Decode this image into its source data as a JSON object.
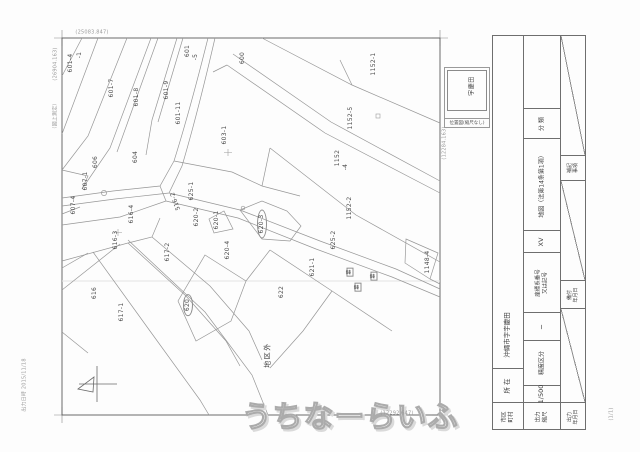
{
  "watermark": {
    "text": "うちなーらいふ"
  },
  "page_number": "(1/1)",
  "print_note": "出力日時 2015/11/18",
  "coords": {
    "top_left_h": "(25083.847)",
    "top_left_v": "(26904.163)",
    "left_note": "（図上測定）",
    "bottom_right_h": "(12292.647)",
    "right_v": "(12284.163)"
  },
  "inset": {
    "area_name": "宇慶田",
    "caption": "位置図(縮尺なし)"
  },
  "map": {
    "district_note": "地区外",
    "parcels": [
      {
        "t": "601-4",
        "x": 71,
        "y": 63
      },
      {
        "t": "-1",
        "x": 80,
        "y": 55
      },
      {
        "t": "601-7",
        "x": 112,
        "y": 88
      },
      {
        "t": "601-8",
        "x": 137,
        "y": 97
      },
      {
        "t": "601-9",
        "x": 167,
        "y": 90
      },
      {
        "t": "601-11",
        "x": 179,
        "y": 113
      },
      {
        "t": "601",
        "x": 188,
        "y": 51
      },
      {
        "t": "-5",
        "x": 196,
        "y": 57
      },
      {
        "t": "600",
        "x": 243,
        "y": 58
      },
      {
        "t": "1152-1",
        "x": 374,
        "y": 64
      },
      {
        "t": "1152-5",
        "x": 351,
        "y": 118
      },
      {
        "t": "1152",
        "x": 338,
        "y": 158
      },
      {
        "t": "-4",
        "x": 346,
        "y": 167
      },
      {
        "t": "1152-2",
        "x": 350,
        "y": 208
      },
      {
        "t": "603-1",
        "x": 225,
        "y": 135
      },
      {
        "t": "604",
        "x": 136,
        "y": 157
      },
      {
        "t": "606",
        "x": 96,
        "y": 162
      },
      {
        "t": "607-1",
        "x": 86,
        "y": 181
      },
      {
        "t": "607-4",
        "x": 74,
        "y": 205
      },
      {
        "t": "516-2",
        "x": 176,
        "y": 201,
        "rot": -110
      },
      {
        "t": "616-4",
        "x": 132,
        "y": 214
      },
      {
        "t": "616-3",
        "x": 116,
        "y": 240
      },
      {
        "t": "617-2",
        "x": 168,
        "y": 252
      },
      {
        "t": "625-1",
        "x": 192,
        "y": 191
      },
      {
        "t": "620-2",
        "x": 197,
        "y": 217
      },
      {
        "t": "620-1",
        "x": 217,
        "y": 220
      },
      {
        "t": "620-3",
        "x": 262,
        "y": 224,
        "ellipse": true
      },
      {
        "t": "620-4",
        "x": 228,
        "y": 250
      },
      {
        "t": "625-2",
        "x": 334,
        "y": 240
      },
      {
        "t": "621-1",
        "x": 313,
        "y": 267
      },
      {
        "t": "622",
        "x": 282,
        "y": 292
      },
      {
        "t": "616",
        "x": 95,
        "y": 293
      },
      {
        "t": "617-1",
        "x": 122,
        "y": 312
      },
      {
        "t": "620",
        "x": 188,
        "y": 305,
        "ellipse": true
      },
      {
        "t": "1148-4",
        "x": 428,
        "y": 262
      },
      {
        "t": "墓",
        "x": 350,
        "y": 272,
        "boxed": true
      },
      {
        "t": "墓",
        "x": 374,
        "y": 276,
        "boxed": true
      },
      {
        "t": "墓",
        "x": 358,
        "y": 287,
        "boxed": true
      },
      {
        "t": "地区外",
        "x": 268,
        "y": 355,
        "big": true
      }
    ]
  },
  "title_block": {
    "y": 35,
    "h": 395,
    "columns": [
      {
        "x": 492,
        "w": 32,
        "cells": [
          {
            "kind": "blank",
            "h": 265,
            "noline": true
          },
          {
            "kind": "text",
            "h": 68,
            "text": "沖縄市字宇慶田",
            "fs": 6.5
          },
          {
            "kind": "text",
            "h": 34,
            "text": "所 在",
            "fs": 6.5
          },
          {
            "kind": "text2",
            "h": 28,
            "lines": [
              "市区",
              "町村"
            ],
            "fs": 5.5
          }
        ]
      },
      {
        "x": 523,
        "w": 38,
        "cells": [
          {
            "kind": "blank",
            "h": 73
          },
          {
            "kind": "text",
            "h": 30,
            "text": "分 類",
            "fs": 6
          },
          {
            "kind": "text",
            "h": 92,
            "text": "地図（法第14条第1項）",
            "fs": 6
          },
          {
            "kind": "text",
            "h": 22,
            "text": "XV",
            "fs": 6.5
          },
          {
            "kind": "text2",
            "h": 60,
            "lines": [
              "座標系番号",
              "又は記号"
            ],
            "fs": 5.5
          },
          {
            "kind": "text",
            "h": 28,
            "text": "─",
            "fs": 7
          },
          {
            "kind": "text",
            "h": 45,
            "text": "精度区分",
            "fs": 6
          },
          {
            "kind": "text",
            "h": 17,
            "text": "1/500",
            "fs": 6.5
          },
          {
            "kind": "text2",
            "h": 28,
            "lines": [
              "出力",
              "縮尺"
            ],
            "fs": 5.5
          }
        ]
      },
      {
        "x": 560,
        "w": 26,
        "cells": [
          {
            "kind": "diag",
            "h": 120
          },
          {
            "kind": "text2",
            "h": 25,
            "lines": [
              "補記",
              "事項"
            ],
            "fs": 5
          },
          {
            "kind": "diag",
            "h": 100
          },
          {
            "kind": "text2",
            "h": 28,
            "lines": [
              "備付",
              "年月日"
            ],
            "fs": 5
          },
          {
            "kind": "diag",
            "h": 94
          },
          {
            "kind": "text2",
            "h": 28,
            "lines": [
              "出力",
              "年月日"
            ],
            "fs": 5
          }
        ]
      }
    ]
  }
}
